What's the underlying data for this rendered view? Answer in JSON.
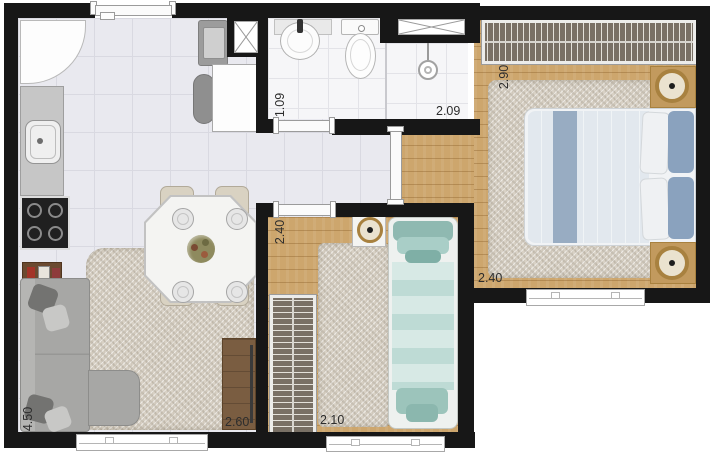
{
  "dimensions": {
    "bathroom_depth": "1.09",
    "bathroom_width": "2.09",
    "bedroom1_depth": "2.90",
    "bedroom1_width": "2.40",
    "bedroom2_depth": "2.40",
    "bedroom2_width": "2.10",
    "living_depth": "4.50",
    "living_width": "2.60"
  },
  "colors": {
    "wall": "#171717",
    "wood_floor": "#cda66d",
    "tile_floor": "#e9e9ef",
    "bath_tile": "#f6f6f8",
    "rug": "#d8d1c5",
    "wardrobe": "#797065",
    "bed1_blue": "#8aa2be",
    "bed2_teal": "#9cc4bb",
    "sofa_gray": "#a7a7a5"
  }
}
